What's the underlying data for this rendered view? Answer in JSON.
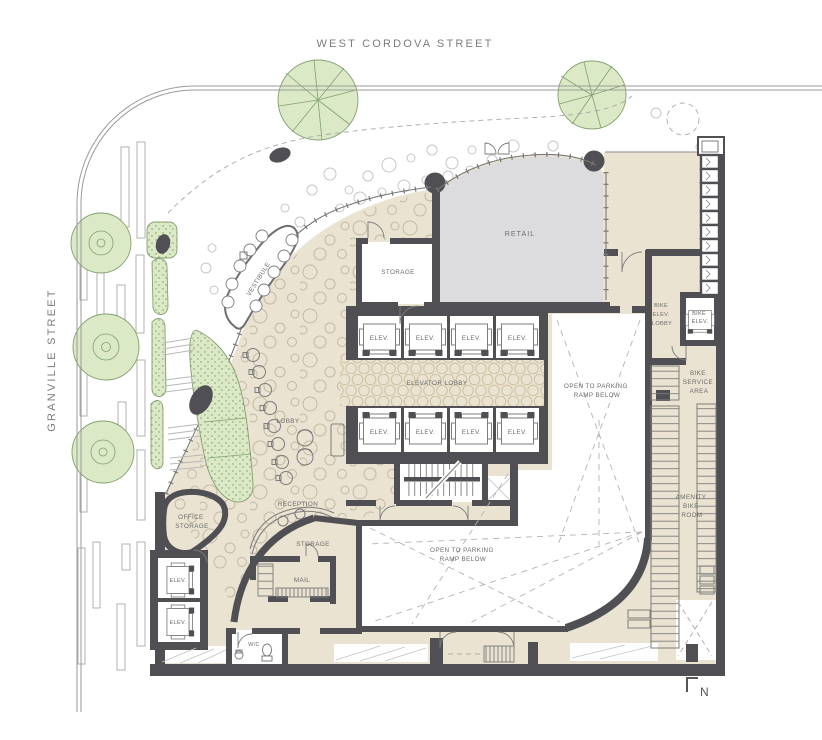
{
  "drawing_title": "Ground floor site plan",
  "streets": {
    "top": "WEST CORDOVA STREET",
    "left": "GRANVILLE STREET"
  },
  "rooms": {
    "retail": "RETAIL",
    "storage": "STORAGE",
    "vestibule": "VESTIBULE",
    "elevator_lobby": "ELEVATOR LOBBY",
    "elev": "ELEV.",
    "lobby": "LOBBY",
    "reception": "RECEPTION",
    "office_storage": [
      "OFFICE",
      "STORAGE"
    ],
    "mail": "MAIL",
    "wc": "W/C",
    "bike_elev_lobby": [
      "BIKE",
      "ELEV.",
      "LOBBY"
    ],
    "bike_elev": [
      "BIKE",
      "ELEV."
    ],
    "bike_service_area": [
      "BIKE",
      "SERVICE",
      "AREA"
    ],
    "amenity_bike_room": [
      "AMENITY",
      "BIKE",
      "ROOM"
    ],
    "open_to_parking": [
      "OPEN TO PARKING",
      "RAMP BELOW"
    ]
  },
  "compass": {
    "north": "N"
  },
  "colors": {
    "wall": "#504f54",
    "floor_beige": "#eae3d1",
    "retail_gray": "#dcdcde",
    "landscape_green": "#dbe9c6",
    "landscape_stroke": "#84a06e",
    "line_gray": "#8a8a8a",
    "text_gray": "#6b6b6b",
    "dash_gray": "#b3b3b3",
    "background": "#ffffff"
  }
}
